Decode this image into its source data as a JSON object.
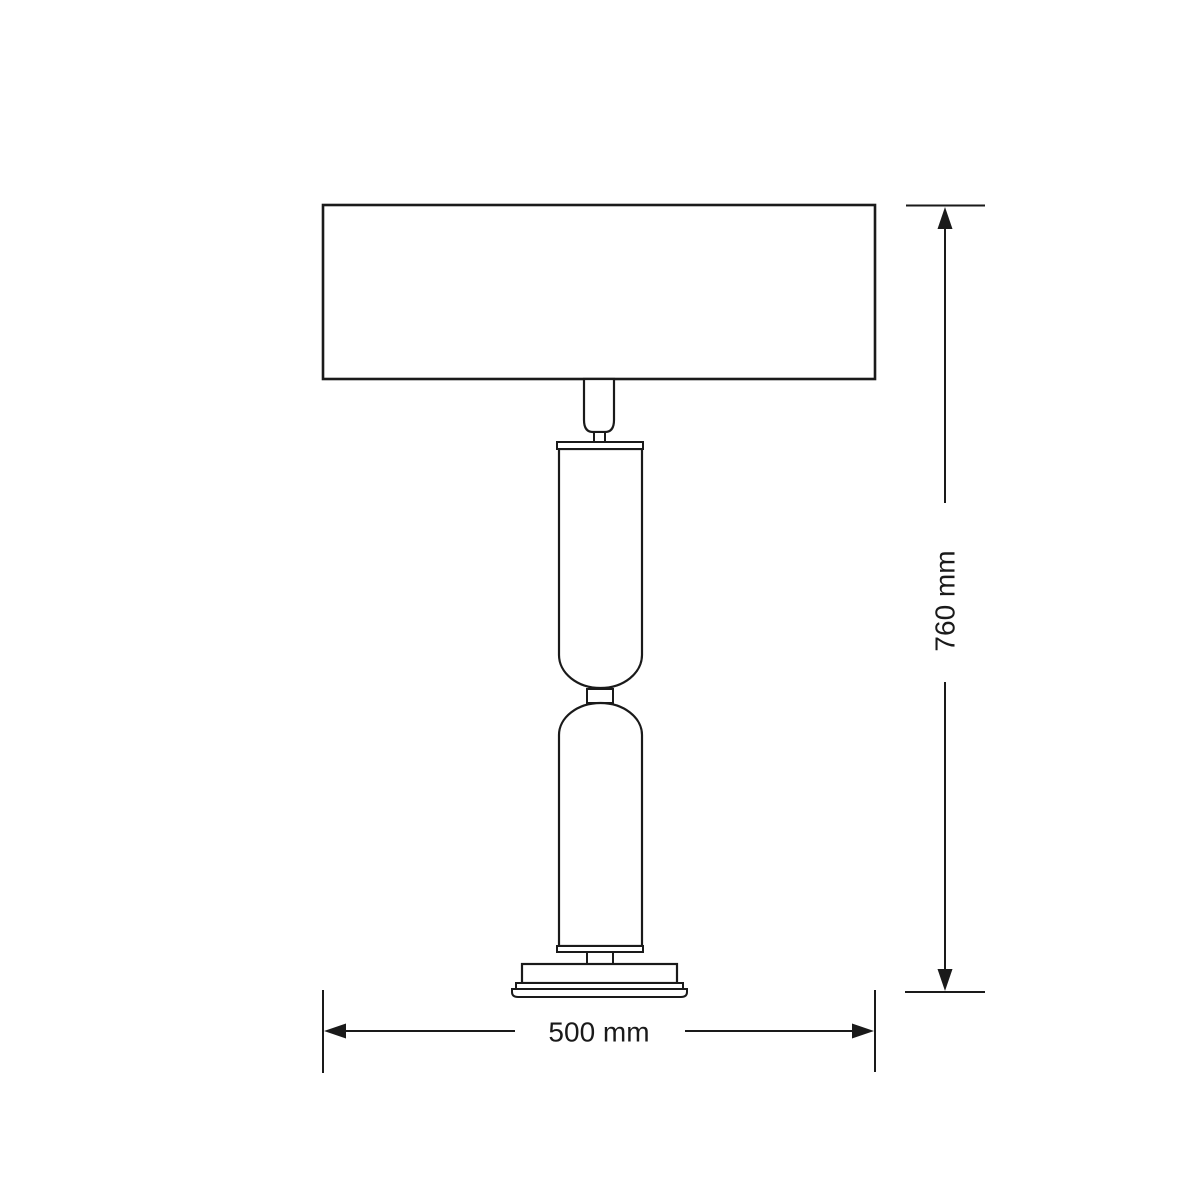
{
  "page": {
    "background": "#ffffff"
  },
  "drawing": {
    "type": "technical-dimension-drawing",
    "subject": "table lamp front elevation",
    "stroke_color": "#1a1a1a",
    "fill_color": "#ffffff",
    "dimensions": {
      "height": {
        "label": "760 mm",
        "value": 760,
        "unit": "mm",
        "orientation": "vertical"
      },
      "width": {
        "label": "500 mm",
        "value": 500,
        "unit": "mm",
        "orientation": "horizontal"
      }
    },
    "parts": [
      "lampshade",
      "socket",
      "socket-neck",
      "top-cap",
      "upper-cylinder",
      "connector-ring",
      "lower-cylinder",
      "bottom-cap",
      "base-stem",
      "base-upper-tier",
      "base-middle-tier",
      "base-bottom-tier"
    ]
  }
}
